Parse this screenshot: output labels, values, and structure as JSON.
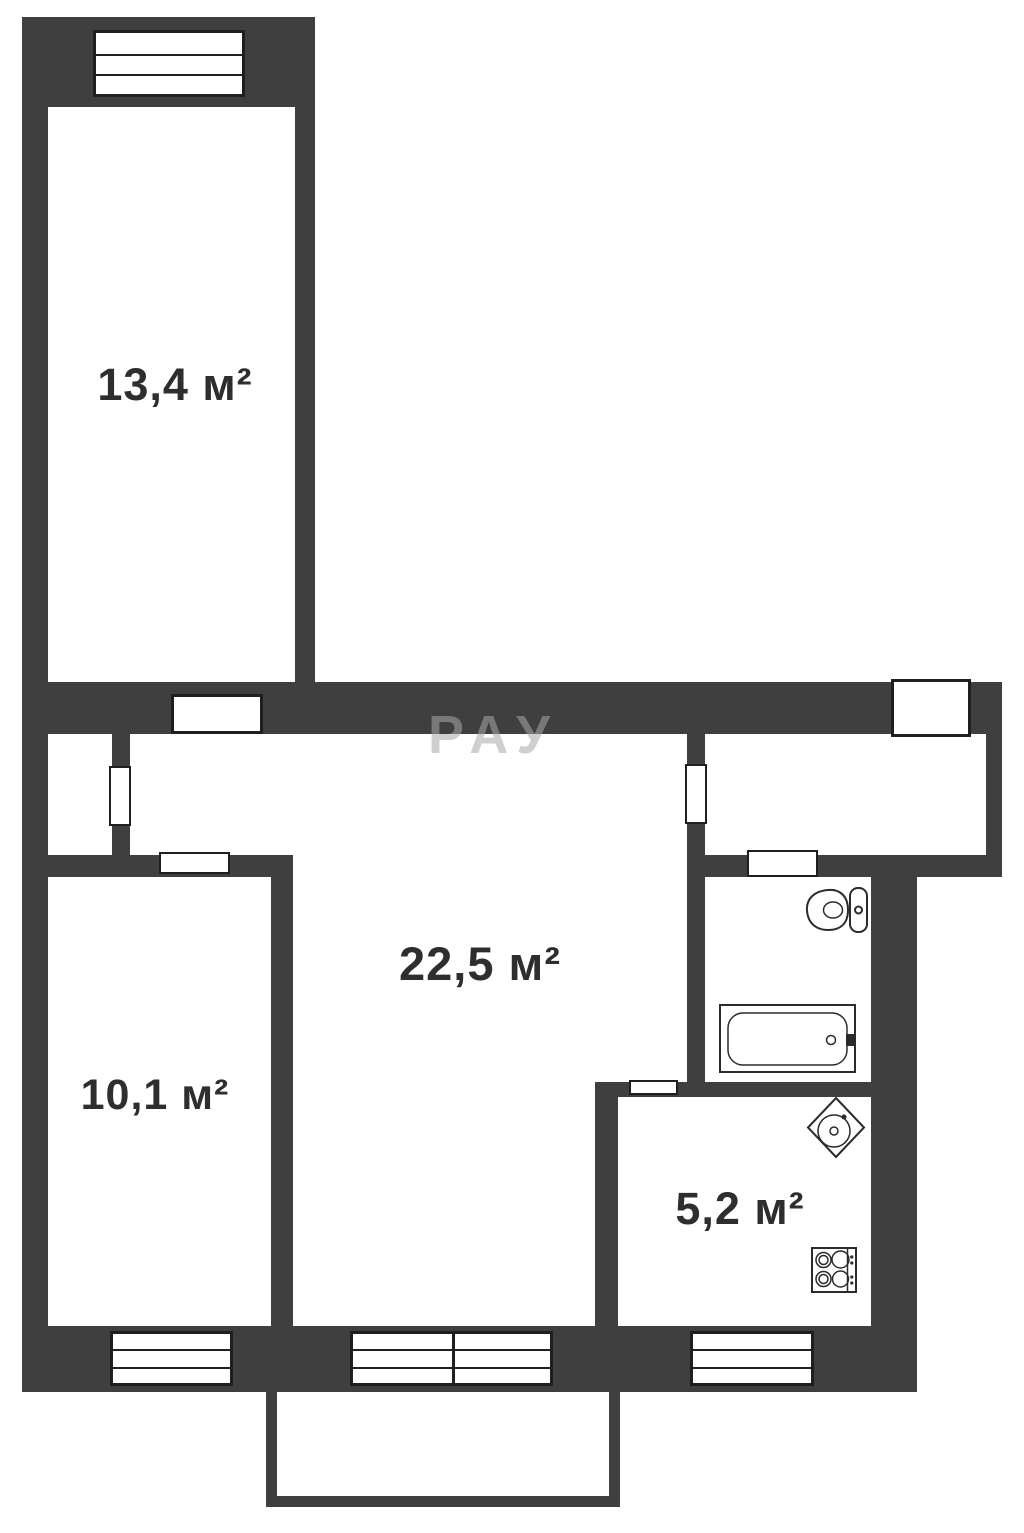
{
  "plan_type": "apartment-floor-plan",
  "colors": {
    "wall": "#3f3f3f",
    "outline": "#1f1f1f",
    "label_text": "#2e2e2e",
    "floor": "#ffffff"
  },
  "watermark": "РАУ",
  "rooms": {
    "bedroom_top": {
      "label": "13,4 м²"
    },
    "living": {
      "label": "22,5 м²"
    },
    "bedroom_bottom": {
      "label": "10,1 м²"
    },
    "kitchen": {
      "label": "5,2 м²"
    }
  },
  "fixtures": {
    "bathroom": [
      "toilet-icon",
      "bathtub-icon"
    ],
    "kitchen": [
      "kitchen-sink-icon",
      "stove-icon"
    ]
  },
  "openings": {
    "windows": [
      "window-bedroom-top",
      "window-bedroom-bottom",
      "window-living-double",
      "window-kitchen"
    ],
    "doors": [
      "entrance-door",
      "door-bedroom-top",
      "door-bedroom-bottom",
      "door-closet",
      "door-hallway",
      "door-bathroom",
      "door-kitchen"
    ],
    "balcony": "balcony-outline"
  }
}
